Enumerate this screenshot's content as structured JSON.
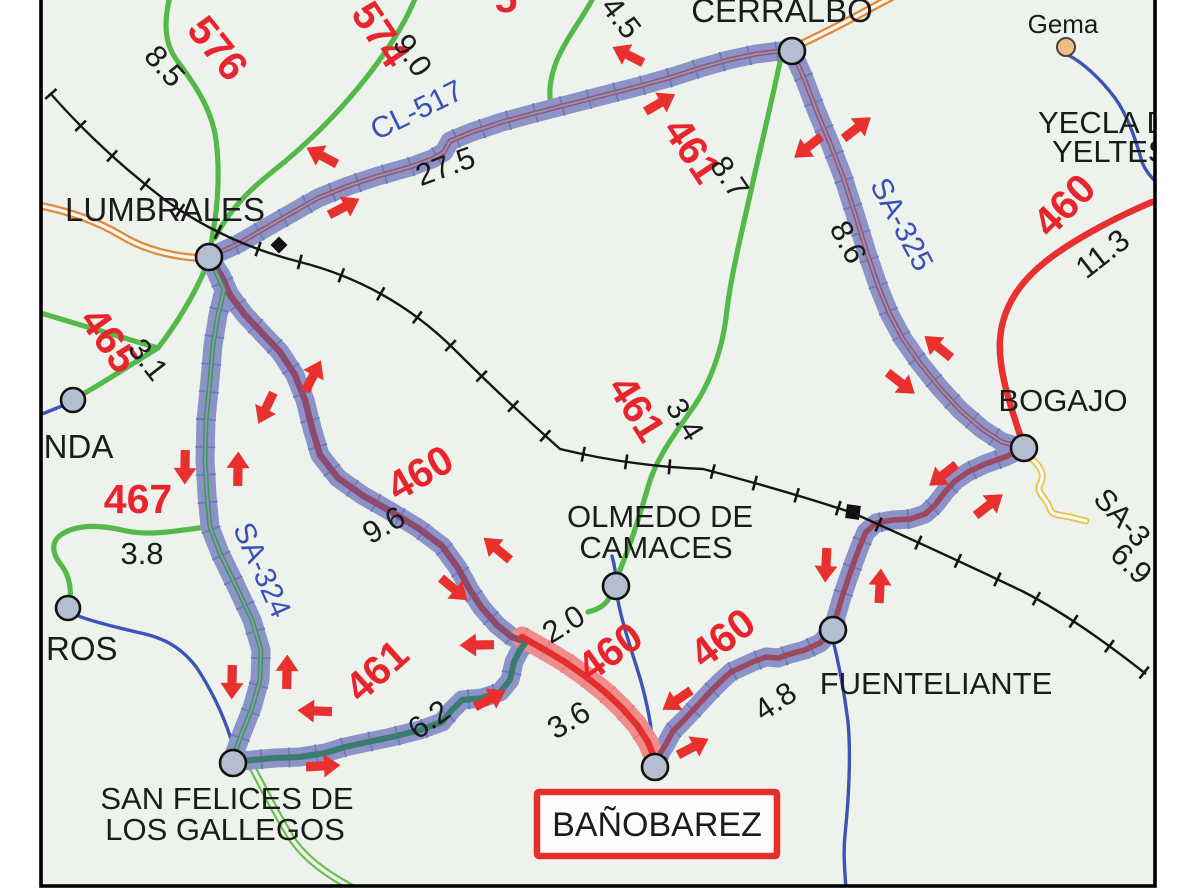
{
  "map": {
    "towns": {
      "lumbrales": "LUMBRALES",
      "cerralbo": "CERRALBO",
      "bogajo": "BOGAJO",
      "olmedo_line1": "OLMEDO DE",
      "olmedo_line2": "CAMACES",
      "fuenteliante": "FUENTELIANTE",
      "banobarez": "BAÑOBAREZ",
      "san_felices_line1": "SAN FELICES DE",
      "san_felices_line2": "LOS GALLEGOS",
      "gema": "Gema",
      "yecla_line1": "YECLA DE",
      "yecla_line2": "YELTES",
      "redonda_partial": "ONDA",
      "aceiteros_partial": "ROS"
    },
    "route_names": {
      "cl517": "CL-517",
      "sa324": "SA-324",
      "sa325": "SA-325",
      "sa3_partial": "SA-3"
    },
    "road_numbers": {
      "n576": "576",
      "n574": "574",
      "n461_north": "461",
      "n461_mid": "461",
      "n461_west": "461",
      "n460_east": "460",
      "n460_diag": "460",
      "n460_closed": "460",
      "n460_fuente": "460",
      "n465": "465",
      "n467": "467",
      "n5_partial": "5"
    },
    "distances": {
      "d8_5": "8.5",
      "d9_0": "9.0",
      "d27_5": "27.5",
      "d4_5": "4.5",
      "d8_7": "8.7",
      "d3_4": "3.4",
      "d11_3": "11.3",
      "d8_6": "8.6",
      "d6_9": "6.9",
      "d3_1": "3.1",
      "d3_8": "3.8",
      "d9_6": "9.6",
      "d2_0": "2.0",
      "d3_6": "3.6",
      "d4_8": "4.8",
      "d6_2": "6.2"
    },
    "colors": {
      "detour_highlight": "#8b93c9",
      "closed_section_band": "#ef8d8d",
      "closed_road": "#e4302d",
      "arrow_red": "#e8312e",
      "label_red": "#e8252c",
      "label_blue": "#3a50b8",
      "road_green": "#54b84a",
      "road_red": "#e8312e",
      "road_orange": "#e2893b",
      "road_yellow": "#edc14f",
      "road_blue": "#3c54b4",
      "railway": "#151515",
      "node_fill": "#b3bed0",
      "gema_node_fill": "#f0bd85",
      "background": "#edf3ec"
    }
  }
}
